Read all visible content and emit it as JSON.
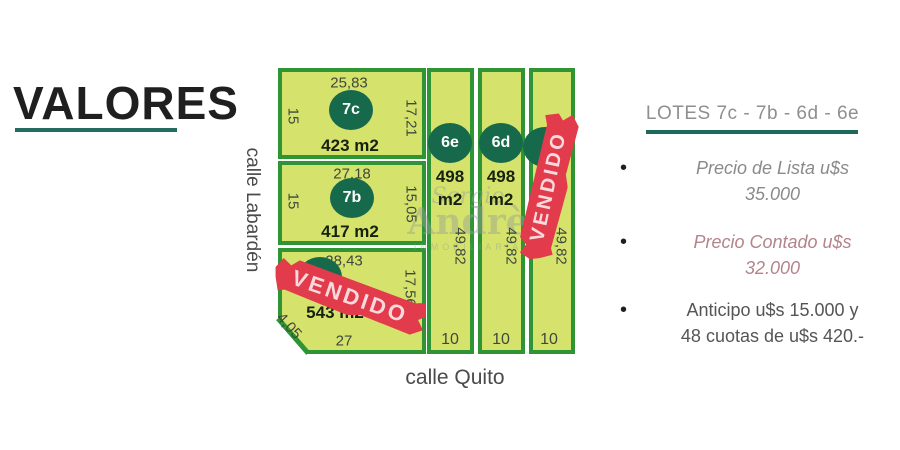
{
  "title": {
    "text": "VALORES"
  },
  "streets": {
    "vertical": "calle Labardén",
    "horizontal": "calle Quito"
  },
  "lots": {
    "7c": {
      "id": "7c",
      "area": "423 m2",
      "top": "25,83",
      "left": "15",
      "right": "17,21"
    },
    "7b": {
      "id": "7b",
      "area": "417 m2",
      "top": "27,18",
      "left": "15",
      "right": "15,05"
    },
    "sold_corner": {
      "area": "543 m2",
      "top": "28,43",
      "right": "17,56",
      "bottom": "27",
      "chamfer": "4,05",
      "status": "VENDIDO"
    },
    "6e": {
      "id": "6e",
      "area_line1": "498",
      "area_line2": "m2",
      "side": "49,82",
      "bottom": "10"
    },
    "6d": {
      "id": "6d",
      "area_line1": "498",
      "area_line2": "m2",
      "side": "49,82",
      "bottom": "10"
    },
    "sold_strip": {
      "side": "49,82",
      "bottom": "10",
      "status": "VENDIDO"
    }
  },
  "sold_label": "VENDIDO",
  "panel": {
    "heading": "LOTES  7c - 7b - 6d - 6e",
    "bullets": [
      {
        "line1": "Precio de Lista u$s",
        "line2": "35.000"
      },
      {
        "line1": "Precio Contado u$s",
        "line2": "32.000"
      },
      {
        "line1": "Anticipo u$s 15.000 y",
        "line2": "48 cuotas de u$s 420.-"
      }
    ]
  },
  "watermark": {
    "line1": "Sergio",
    "line2": "Andrè",
    "line3": "INMOBILIARIA"
  },
  "colors": {
    "accent_teal": "#1c6a5e",
    "lot_fill": "#d5e36c",
    "lot_border": "#2e9434",
    "badge_green": "#17694c",
    "sold_red": "#e13b4c",
    "list_gray": "#8a8a8a",
    "cash_rose": "#b3848b"
  }
}
